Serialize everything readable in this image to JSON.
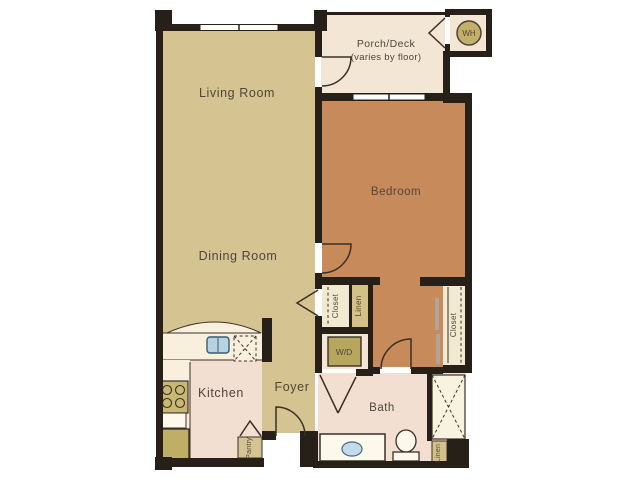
{
  "rooms": {
    "living": {
      "label": "Living Room"
    },
    "dining": {
      "label": "Dining Room"
    },
    "kitchen": {
      "label": "Kitchen"
    },
    "foyer": {
      "label": "Foyer"
    },
    "bath": {
      "label": "Bath"
    },
    "bedroom": {
      "label": "Bedroom"
    },
    "porch": {
      "label": "Porch/Deck",
      "sublabel": "(varies by floor)"
    },
    "pantry": {
      "label": "Pantry"
    },
    "closet_hall": {
      "label": "Closet"
    },
    "linen_hall": {
      "label": "Linen"
    },
    "closet_bedroom": {
      "label": "Closet"
    },
    "linen_bath": {
      "label": "Linen"
    }
  },
  "fixtures": {
    "water_heater": {
      "label": "WH"
    },
    "washer_dryer": {
      "label": "W/D"
    }
  },
  "colors": {
    "floor_tan": "#d5c391",
    "floor_orange": "#c78a5b",
    "floor_cream": "#f3e6d4",
    "floor_pink": "#f3ded2",
    "counter_cream": "#f8f0dc",
    "appliance_tan": "#bfae66",
    "wall_black": "#262019",
    "sink_blue": "#b7d2e3",
    "label_text": "#4f463b"
  }
}
